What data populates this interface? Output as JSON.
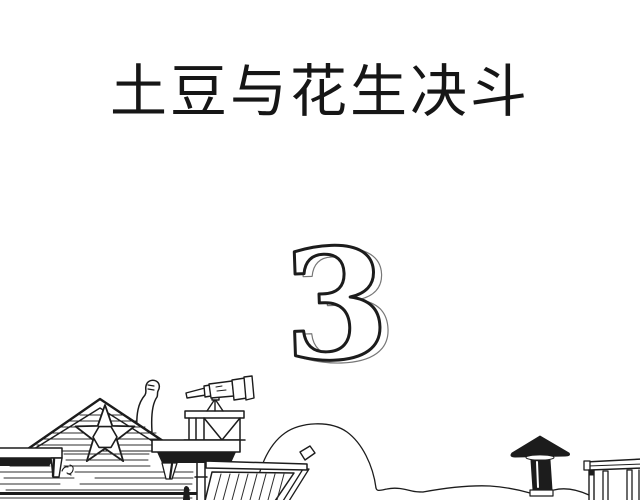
{
  "page": {
    "background_color": "#ffffff",
    "ink_color": "#1c1c1c"
  },
  "comic": {
    "title": "土豆与花生决斗",
    "chapter_number": "3"
  },
  "scene": {
    "label": "hand-drawn western town rooftops",
    "elements": {
      "saloon": "wood-plank saloon gable with sheriff star",
      "weathervane": "fist-shaped weathervane behind the roof",
      "platform": "lookout platform with railing",
      "telescope": "telescope on tripod pointing left",
      "awning": "striped sloped awning",
      "bush": "round bush outline",
      "chimney": "black capped chimney",
      "shed": "vertical-plank shed corner"
    }
  }
}
